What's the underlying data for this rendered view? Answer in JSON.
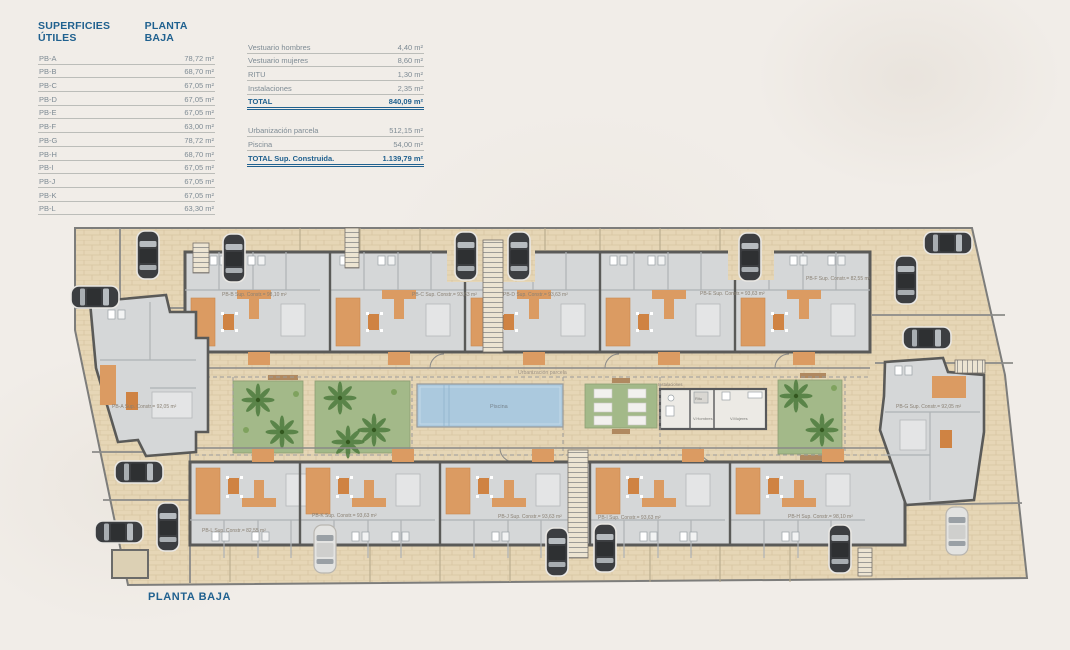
{
  "tables": {
    "superficies": {
      "title": "SUPERFICIES ÚTILES",
      "subtitle": "PLANTA BAJA",
      "rows": [
        {
          "label": "PB-A",
          "value": "78,72 m²"
        },
        {
          "label": "PB-B",
          "value": "68,70 m²"
        },
        {
          "label": "PB-C",
          "value": "67,05 m²"
        },
        {
          "label": "PB-D",
          "value": "67,05 m²"
        },
        {
          "label": "PB-E",
          "value": "67,05 m²"
        },
        {
          "label": "PB-F",
          "value": "63,00 m²"
        },
        {
          "label": "PB-G",
          "value": "78,72 m²"
        },
        {
          "label": "PB-H",
          "value": "68,70 m²"
        },
        {
          "label": "PB-I",
          "value": "67,05 m²"
        },
        {
          "label": "PB-J",
          "value": "67,05 m²"
        },
        {
          "label": "PB-K",
          "value": "67,05 m²"
        },
        {
          "label": "PB-L",
          "value": "63,30 m²"
        }
      ]
    },
    "resumen": {
      "rows": [
        {
          "label": "Vestuario hombres",
          "value": "4,40 m²"
        },
        {
          "label": "Vestuario mujeres",
          "value": "8,60 m²"
        },
        {
          "label": "RITU",
          "value": "1,30 m²"
        },
        {
          "label": "Instalaciones",
          "value": "2,35 m²"
        }
      ],
      "total": {
        "label": "TOTAL",
        "value": "840,09 m²"
      },
      "rows2": [
        {
          "label": "Urbanización parcela",
          "value": "512,15 m²"
        },
        {
          "label": "Piscina",
          "value": "54,00 m²"
        }
      ],
      "total2": {
        "label": "TOTAL Sup. Construida.",
        "value": "1.139,79 m²"
      }
    }
  },
  "plan": {
    "footer": "PLANTA BAJA",
    "pool_label": "Piscina",
    "parcel_label": "Urbanización parcela",
    "facilities": {
      "title": "Instalaciones",
      "room1": "Ritu",
      "room2": "V.Hombres",
      "room3": "V.Mujeres"
    },
    "units": {
      "a": "PB-A Sup. Constr.= 92,05 m²",
      "b": "PB-B Sup. Constr.= 98,10 m²",
      "c": "PB-C Sup. Constr.= 93,63 m²",
      "d": "PB-D Sup. Constr.= 93,63 m²",
      "e": "PB-E Sup. Constr.= 93,63 m²",
      "f": "PB-F Sup. Constr.= 82,55 m²",
      "g": "PB-G Sup. Constr.= 92,05 m²",
      "h": "PB-H Sup. Constr.= 98,10 m²",
      "i": "PB-I Sup. Constr.= 93,63 m²",
      "j": "PB-J Sup. Constr.= 93,63 m²",
      "k": "PB-K Sup. Constr.= 93,63 m²",
      "l": "PB-L Sup. Constr.= 82,55 m²"
    }
  },
  "colors": {
    "accent_blue": "#20618f",
    "row_text": "#7e8b94",
    "site_beige": "#e6d6b6",
    "wall_gray": "#5a5a58",
    "interior_gray": "#d5d7d8",
    "terrace_orange": "#db9b62",
    "garden_green": "#a3b989",
    "pool_blue": "#abc9de"
  }
}
